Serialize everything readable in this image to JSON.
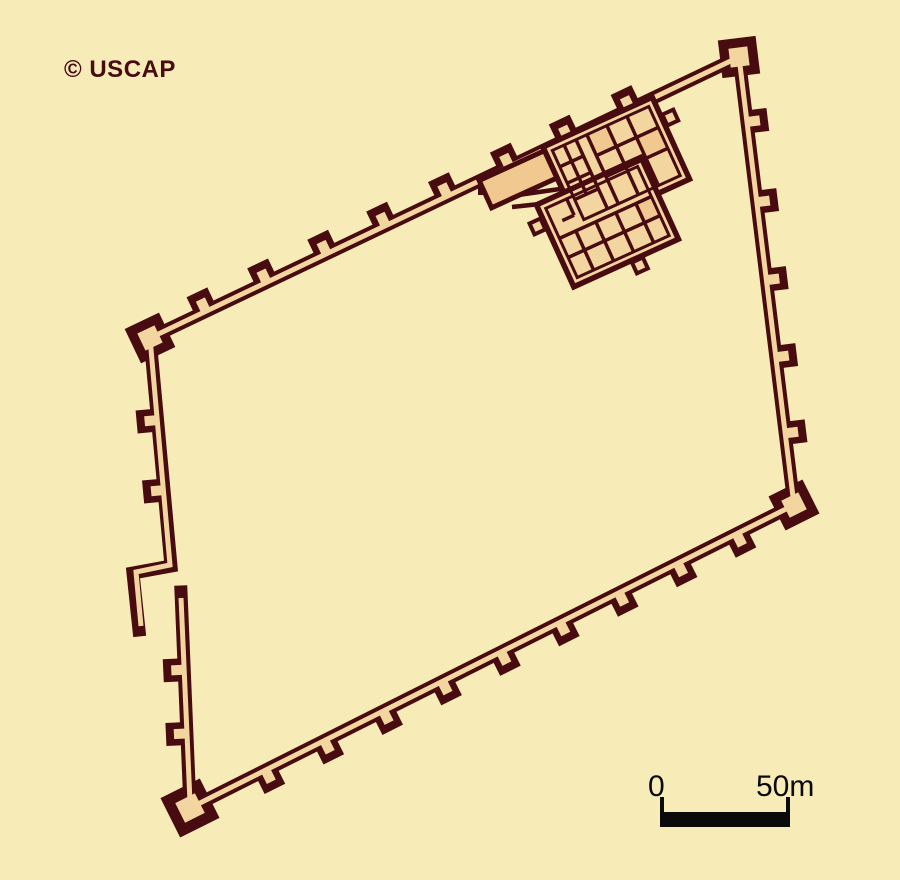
{
  "title": "Fortified enclosure site plan",
  "copyright_label": "© USCAP",
  "scale_bar": {
    "start_label": "0",
    "end_label": "50m"
  },
  "colors": {
    "background": "#F7EBB7",
    "wall_dark": "#470B10",
    "wall_fill": "#F3D5A0",
    "room_accent": "#F1C88F",
    "scale_black": "#0A0A0A"
  },
  "map_data": {
    "corners": {
      "west": [
        150,
        338
      ],
      "north": [
        739,
        57
      ],
      "east": [
        794,
        505
      ],
      "south": [
        190,
        808
      ]
    },
    "wall_geom": {
      "dark_w": 13,
      "fill_w": 5
    },
    "wall_paths_dark": [
      [
        [
          150,
          338
        ],
        [
          739,
          57
        ],
        [
          794,
          505
        ],
        [
          190,
          808
        ]
      ],
      [
        [
          150,
          338
        ],
        [
          171,
          566
        ],
        [
          133,
          573
        ],
        [
          139,
          630
        ]
      ],
      [
        [
          181,
          592
        ],
        [
          190,
          808
        ]
      ]
    ],
    "wall_paths_fill": [
      [
        [
          150,
          338
        ],
        [
          739,
          57
        ],
        [
          794,
          505
        ],
        [
          190,
          808
        ]
      ],
      [
        [
          150,
          338
        ],
        [
          170,
          565
        ],
        [
          136,
          572
        ],
        [
          141,
          626
        ]
      ],
      [
        [
          181,
          598
        ],
        [
          190,
          802
        ]
      ]
    ],
    "tower_geom": {
      "len": 21,
      "dark_w": 23,
      "core_from": 1,
      "core_to": 13,
      "core_w": 10
    },
    "tower_walls": [
      {
        "p1": [
          150,
          338
        ],
        "p2": [
          739,
          57
        ],
        "n": [
          -0.4306,
          -0.9025
        ],
        "ts": [
          0.095,
          0.198,
          0.3,
          0.4,
          0.505,
          0.61,
          0.71,
          0.815
        ]
      },
      {
        "p1": [
          739,
          57
        ],
        "p2": [
          794,
          505
        ],
        "n": [
          0.9925,
          -0.1219
        ],
        "ts": [
          0.145,
          0.324,
          0.498,
          0.67,
          0.84
        ]
      },
      {
        "p1": [
          794,
          505
        ],
        "p2": [
          190,
          808
        ],
        "n": [
          0.4483,
          0.8937
        ],
        "ts": [
          0.095,
          0.1925,
          0.29,
          0.3875,
          0.485,
          0.5825,
          0.68,
          0.7775,
          0.875
        ]
      },
      {
        "p1": [
          150,
          338
        ],
        "p2": [
          171,
          566
        ],
        "n": [
          -0.9958,
          0.0917
        ],
        "ts": [
          0.36,
          0.667
        ]
      },
      {
        "p1": [
          181,
          592
        ],
        "p2": [
          190,
          808
        ],
        "n": [
          -0.9989,
          0.0462
        ],
        "ts": [
          0.36,
          0.655
        ]
      }
    ],
    "corner_towers": [
      {
        "p": [
          150,
          338
        ],
        "rot": -25.5,
        "s": 38
      },
      {
        "p": [
          739,
          57
        ],
        "rot": -7,
        "s": 38
      },
      {
        "p": [
          794,
          505
        ],
        "rot": -26.6,
        "s": 38
      },
      {
        "p": [
          190,
          808
        ],
        "rot": -26.6,
        "s": 44
      }
    ],
    "fragments": {
      "lines": [
        [
          504,
          197,
          560,
          189
        ],
        [
          512,
          207,
          549,
          203
        ]
      ],
      "square": [
        478,
        186,
        9,
        9
      ]
    },
    "building": {
      "translate": [
        613,
        192
      ],
      "rotate": -24.5,
      "hall": [
        -117,
        -66,
        72,
        30
      ],
      "blocks": [
        [
          -45,
          -70,
          120,
          90
        ],
        [
          -75,
          -20,
          115,
          90
        ]
      ],
      "inner_rects": [
        [
          -38,
          -63,
          106,
          76
        ],
        [
          -68,
          -13,
          101,
          76
        ]
      ],
      "accent_rooms": [
        [
          0,
          -63,
          22,
          23
        ],
        [
          44,
          -40,
          24,
          22
        ],
        [
          16,
          20,
          17,
          21
        ]
      ],
      "grid_lines": [
        [
          -12,
          -63,
          -12,
          13
        ],
        [
          0,
          -63,
          0,
          13
        ],
        [
          -25,
          -63,
          -25,
          -9
        ],
        [
          -38,
          -45,
          -12,
          -45
        ],
        [
          -38,
          -27,
          -12,
          -27
        ],
        [
          -38,
          -9,
          -12,
          -9
        ],
        [
          22,
          -63,
          22,
          13
        ],
        [
          44,
          -63,
          44,
          13
        ],
        [
          0,
          -40,
          68,
          -40
        ],
        [
          0,
          -17,
          68,
          -17
        ],
        [
          -68,
          20,
          33,
          20
        ],
        [
          -68,
          41,
          33,
          41
        ],
        [
          -50,
          20,
          -50,
          63
        ],
        [
          -28,
          20,
          -28,
          63
        ],
        [
          -6,
          20,
          -6,
          63
        ],
        [
          16,
          20,
          16,
          63
        ],
        [
          -45,
          -13,
          -45,
          5
        ],
        [
          -58,
          5,
          -45,
          5
        ]
      ],
      "stubs": [
        [
          75,
          -52,
          16,
          16
        ],
        [
          -14,
          70,
          16,
          16
        ],
        [
          -91,
          -8,
          16,
          16
        ]
      ]
    },
    "scale_bar_geom": {
      "bar": [
        660,
        812,
        130,
        15
      ],
      "ticks": [
        [
          660,
          797,
          4,
          15
        ],
        [
          786,
          797,
          4,
          15
        ]
      ]
    }
  }
}
